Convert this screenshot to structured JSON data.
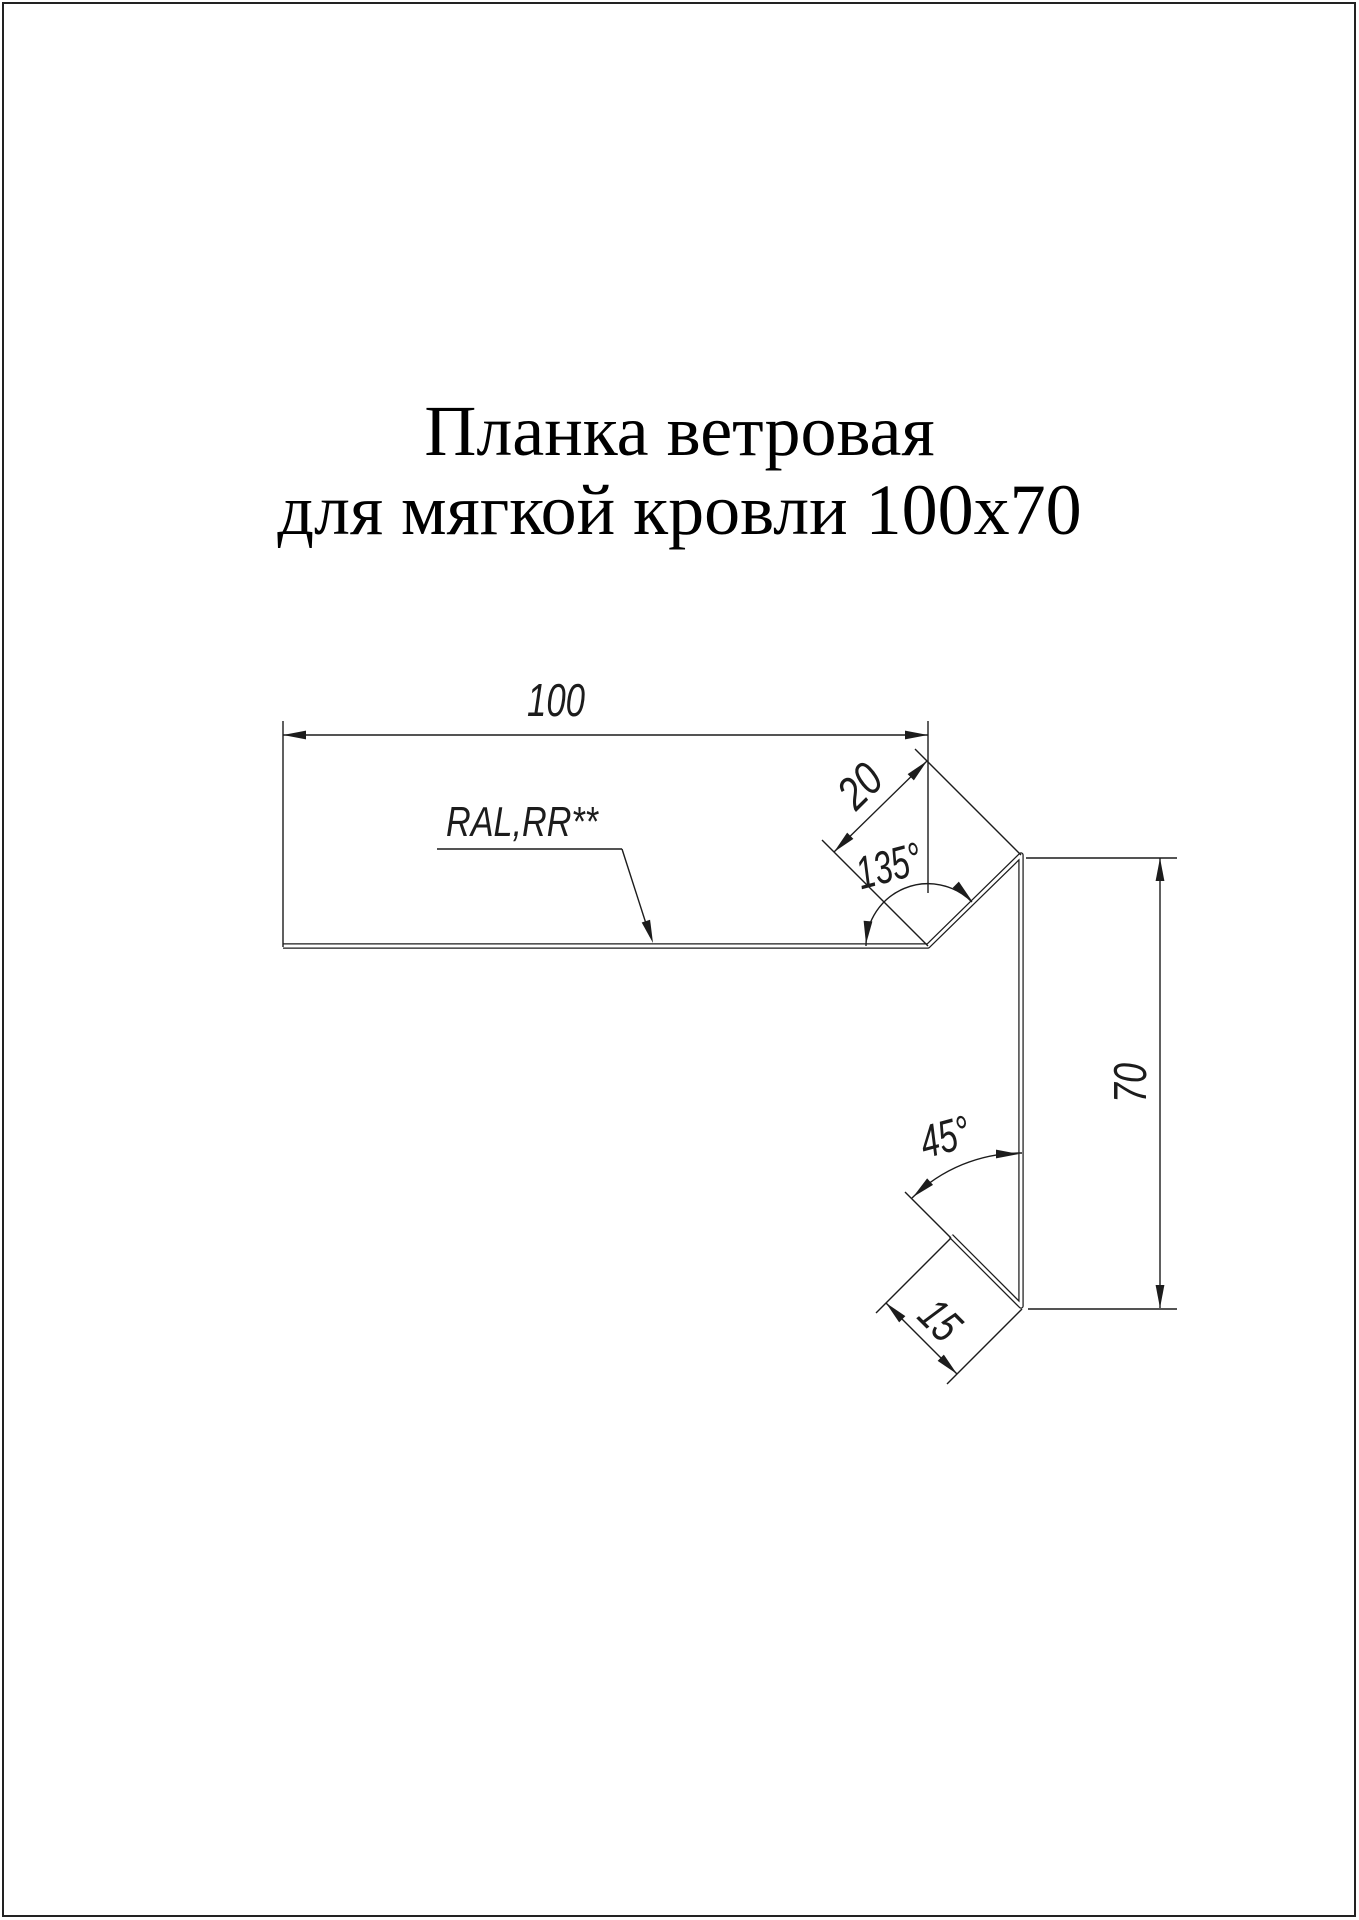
{
  "page": {
    "title_line1": "Планка ветровая",
    "title_line2": "для мягкой кровли 100х70"
  },
  "drawing": {
    "ink_color": "#1c1c1c",
    "labels": {
      "width_top": "100",
      "flange_top": "20",
      "angle_top": "135°",
      "height_right": "70",
      "angle_bottom": "45°",
      "flange_bottom": "15",
      "coating": "RAL,RR**"
    }
  }
}
